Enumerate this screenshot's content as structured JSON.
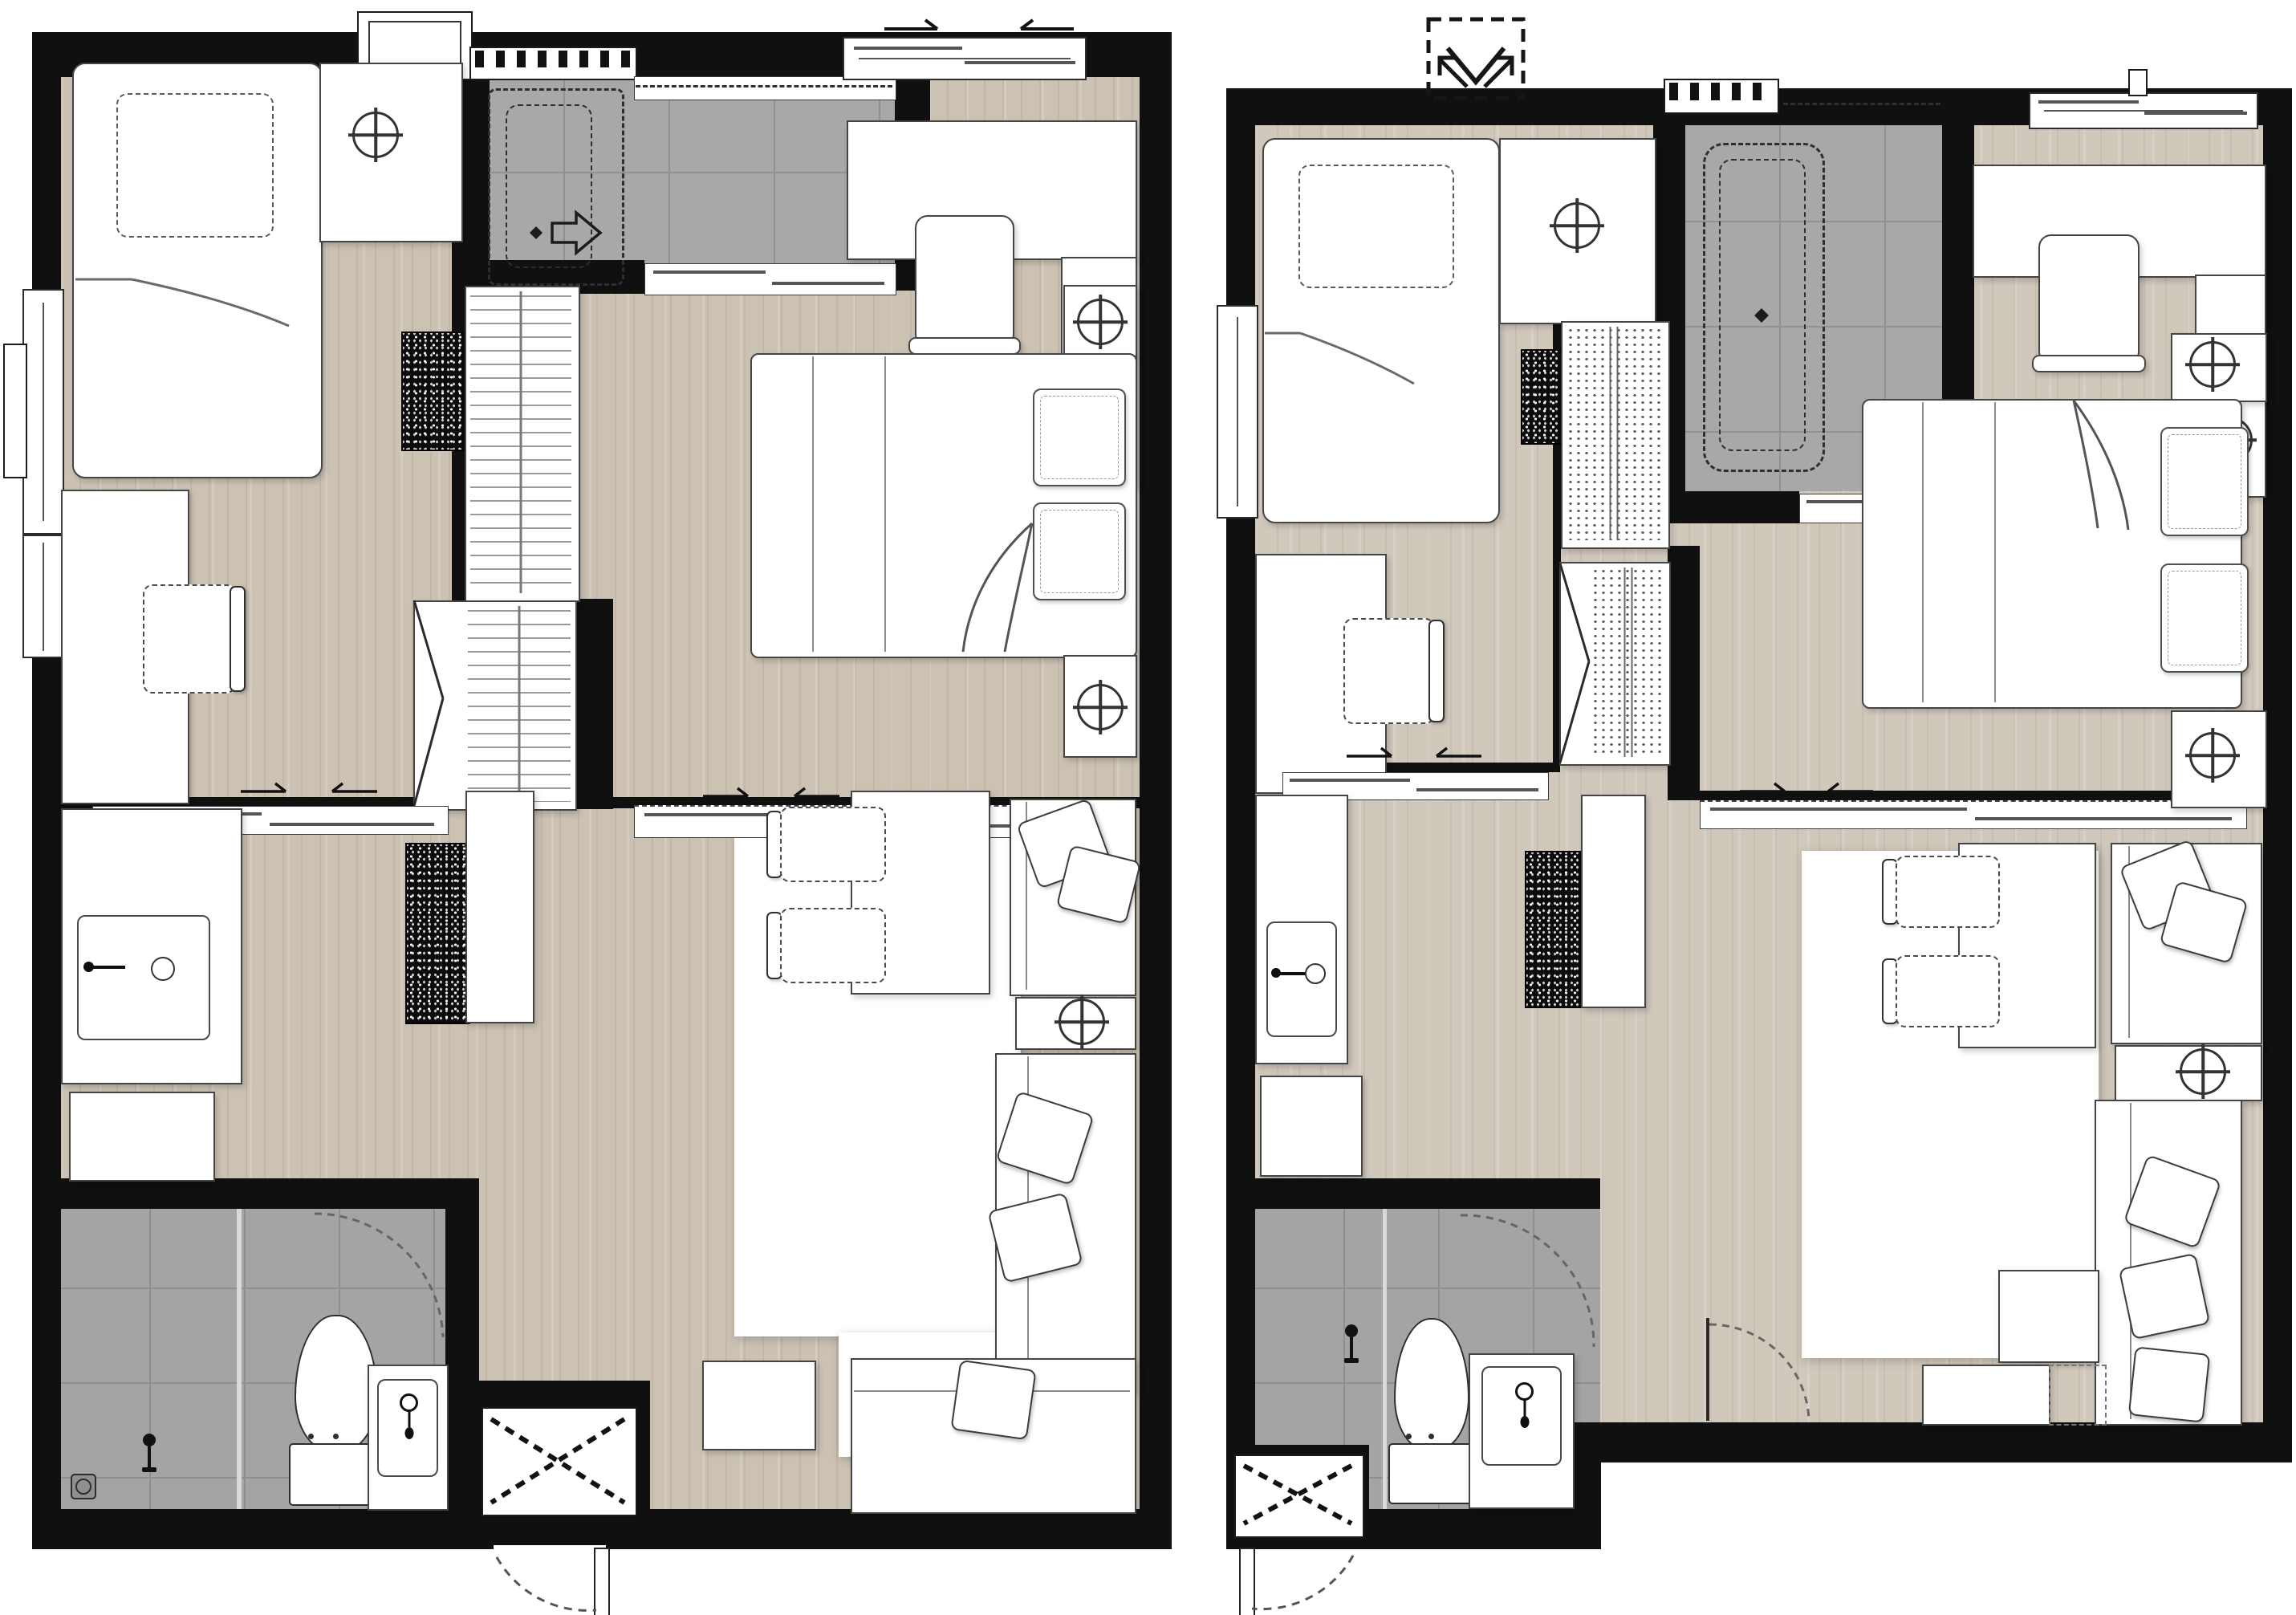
{
  "title": "Side-by-side architectural floor plans of two one-bedroom condominium units (no text labels in drawing)",
  "colors": {
    "wall": "#101010",
    "wood_left": "#ccc2b4",
    "wood_right": "#d1c8bc",
    "tile": "#a8a8a8",
    "tile_line": "#919191",
    "furniture_fill": "#ffffff",
    "furniture_line": "#454545",
    "dash_line": "#5a5a5a"
  },
  "plans": [
    {
      "side": "left",
      "description": "Unit variant A - one bedroom plus multipurpose room, entrance at bottom center",
      "rooms": [
        {
          "name": "multipurpose-room",
          "position": "top-left",
          "furniture": [
            "single-bed",
            "dashed-pillow",
            "blanket-fold",
            "nightstand",
            "table-lamp",
            "desk-counter",
            "desk-chair",
            "full-height-mirror-panel",
            "two-side-windows",
            "exterior-ledge"
          ]
        },
        {
          "name": "shower-room",
          "position": "top-center",
          "furniture": [
            "walk-in-shower-dashed-enclosure",
            "direction-arrow",
            "small-diamond-marker",
            "tile-floor",
            "sliding-door",
            "louver-vent",
            "exterior-ac-unit",
            "high-window-dashed"
          ]
        },
        {
          "name": "master-bedroom",
          "position": "top-right",
          "furniture": [
            "double-bed",
            "two-pillows",
            "blanket-fold",
            "two-nightstands",
            "two-table-lamps",
            "desk-counter",
            "chair",
            "low-cabinet-with-lamp",
            "sliding-window-with-arrows"
          ]
        },
        {
          "name": "wardrobe-zone",
          "position": "center",
          "furniture": [
            "hanger-closet",
            "bifold-door-closet",
            "wall-stub"
          ]
        },
        {
          "name": "kitchen",
          "position": "mid-left",
          "furniture": [
            "counter-with-sink",
            "faucet",
            "drain-ring",
            "under-counter-appliance",
            "tall-dark-unit",
            "white-cabinet"
          ]
        },
        {
          "name": "bathroom",
          "position": "bottom-left",
          "furniture": [
            "toilet",
            "vanity-basin",
            "basin-tap",
            "shower-mixer",
            "floor-drain",
            "glass-partition",
            "door-swing-arc",
            "tile-floor"
          ]
        },
        {
          "name": "living-dining",
          "position": "bottom-right",
          "furniture": [
            "area-rug",
            "dining-table",
            "two-dining-chairs",
            "sofa",
            "two-cushions",
            "side-table",
            "table-lamp",
            "l-shaped-sofa",
            "three-cushions",
            "ottoman-square"
          ]
        },
        {
          "name": "entrance",
          "position": "bottom-center",
          "furniture": [
            "service-shaft-x-box",
            "entry-door-leaf",
            "entry-door-swing-arc"
          ]
        }
      ]
    },
    {
      "side": "right",
      "description": "Unit variant B - one bedroom plus multipurpose room, entrance at bottom left, expand arrow symbol at top",
      "rooms": [
        {
          "name": "multipurpose-room",
          "position": "top-left",
          "furniture": [
            "single-bed",
            "dashed-pillow",
            "blanket-fold",
            "nightstand",
            "table-lamp",
            "desk-counter",
            "desk-chair",
            "side-window"
          ]
        },
        {
          "name": "bathtub-room",
          "position": "top-center",
          "furniture": [
            "bathtub-dashed-outline",
            "diamond-marker",
            "tile-floor",
            "sliding-door",
            "louver-vent",
            "high-window-dashed",
            "expand-arrow-symbol-outside"
          ]
        },
        {
          "name": "master-bedroom",
          "position": "top-right",
          "furniture": [
            "double-bed",
            "two-pillows",
            "blanket-fold",
            "two-nightstands",
            "two-table-lamps",
            "desk-counter",
            "chair",
            "low-cabinet-with-lamp",
            "top-window-band"
          ]
        },
        {
          "name": "wardrobe-zone",
          "position": "center",
          "furniture": [
            "folded-clothes-closet",
            "bifold-door-closet",
            "dark-speckled-panel",
            "wall-stub"
          ]
        },
        {
          "name": "kitchen",
          "position": "mid-left",
          "furniture": [
            "counter-with-sink",
            "faucet",
            "drain-ring",
            "under-counter-appliance",
            "tall-dark-unit",
            "white-cabinet"
          ]
        },
        {
          "name": "bathroom",
          "position": "bottom-left",
          "furniture": [
            "toilet",
            "vanity-basin",
            "basin-tap",
            "shower-mixer",
            "glass-partition",
            "door-swing-arc",
            "tile-floor"
          ]
        },
        {
          "name": "living-dining",
          "position": "bottom-right",
          "furniture": [
            "area-rug",
            "dining-table",
            "two-dining-chairs",
            "sofa",
            "two-cushions",
            "side-table",
            "table-lamp",
            "l-shaped-sofa",
            "chaise",
            "three-cushions",
            "tv-console",
            "dashed-console-extension",
            "interior-door-swing"
          ]
        },
        {
          "name": "entrance",
          "position": "bottom-left-corner",
          "furniture": [
            "service-shaft-x-box",
            "entry-door-leaf",
            "entry-door-swing-arc"
          ]
        }
      ]
    }
  ],
  "symbols_legend": [
    "circle-with-cross = table lamp / light fixture",
    "dashed-rectangle = shower enclosure, bathtub or chair under desk",
    "x-in-box = service shaft",
    "dashed-arc = door swing",
    "comb-strip = louver vent",
    "speckled-black-panel = mirror or dark cabinet"
  ]
}
